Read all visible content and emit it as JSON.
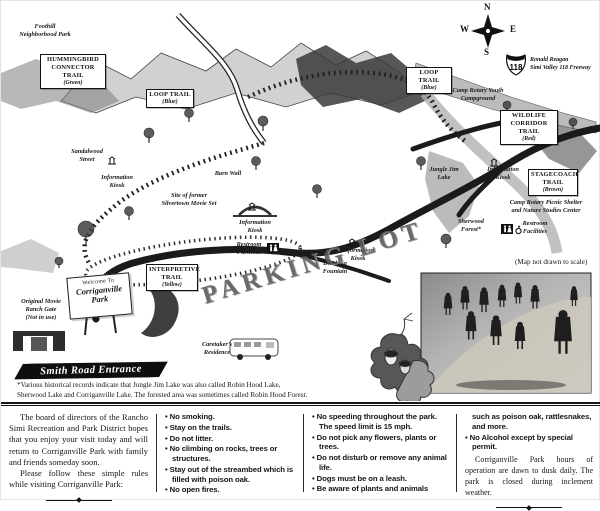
{
  "map": {
    "labels": {
      "foothill_park": "Foothill\nNeighborhood Park",
      "sandalwood_street": "Sandalwood\nStreet",
      "kiosk_nw": "Information\nKiosk",
      "movie_set": "Site of former\nSilvertown Movie Set",
      "barn_wall": "Barn Wall",
      "kiosk_bridge": "Information\nKiosk",
      "restroom_center": "Restroom\nFacilities",
      "kiosk_center": "Information\nKiosk",
      "drinking_fountain": "Drinking\nFountain",
      "jungle_jim_lake": "Jungle Jim\nLake",
      "kiosk_east": "Information\nKiosk",
      "camp_rotary_youth": "Camp Rotary Youth\nCampground",
      "camp_rotary_picnic": "Camp Rotary Picnic Shelter\nand Nature Studies Center",
      "sherwood_forest": "Sherwood\nForest*",
      "restroom_east": "Restroom\nFacilities",
      "caretaker_residence": "Caretaker's\nResidence",
      "original_gate": "Original Movie\nRanch Gate\n(Not in use)",
      "parking_lot": "PARKING LOT",
      "scale_note": "(Map not drawn to scale)",
      "freeway_name": "Ronald Reagan\nSimi Valley 118 Freeway",
      "freeway_shield": "118"
    },
    "trails": {
      "hummingbird": {
        "name": "HUMMINGBIRD\nCONNECTOR TRAIL",
        "note": "(Green)"
      },
      "loop_left": {
        "name": "LOOP TRAIL",
        "note": "(Blue)"
      },
      "loop_right": {
        "name": "LOOP TRAIL",
        "note": "(Blue)"
      },
      "wildlife": {
        "name": "WILDLIFE\nCORRIDOR TRAIL",
        "note": "(Red)"
      },
      "stagecoach": {
        "name": "STAGECOACH\nTRAIL",
        "note": "(Brown)"
      },
      "interpretive": {
        "name": "INTERPRETIVE\nTRAIL",
        "note": "(Yellow)"
      }
    },
    "compass": {
      "north": "N",
      "south": "S",
      "east": "E",
      "west": "W"
    },
    "welcome_sign": {
      "line1": "Welcome To",
      "line2": "Corriganville",
      "line3": "Park"
    },
    "entrance_banner": "Smith Road Entrance",
    "footnote": "*Various historical records indicate that Jungle Jim Lake was also called Robin Hood Lake,\nSherwood Lake and Corriganville Lake. The forested area was sometimes called Robin Hood Forest."
  },
  "rules": {
    "intro_p1": "The board of directors of the Rancho Simi Recreation and Park District hopes that you enjoy your visit today and will return to Corriganville Park with family and friends someday soon.",
    "intro_p2": "Please follow these simple rules while visiting Corriganville Park:",
    "col2": [
      "No smoking.",
      "Stay on the trails.",
      "Do not litter.",
      "No climbing on rocks, trees or structures.",
      "Stay out of the streambed which is filled with poison oak.",
      "No open fires."
    ],
    "col3": [
      "No speeding throughout the park. The speed limit is 15 mph.",
      "Do not pick any flowers, plants or trees.",
      "Do not disturb or remove any animal life.",
      "Dogs must be on a leash.",
      "Be aware of plants and animals"
    ],
    "col4_continuation": "such as poison oak, rattlesnakes, and more.",
    "col4": [
      "No Alcohol except by special permit."
    ],
    "hours": "Corriganville Park hours of operation are dawn to dusk daily. The park is closed during inclement weather."
  },
  "colors": {
    "ink": "#1a1a1a",
    "paper": "#ffffff"
  }
}
